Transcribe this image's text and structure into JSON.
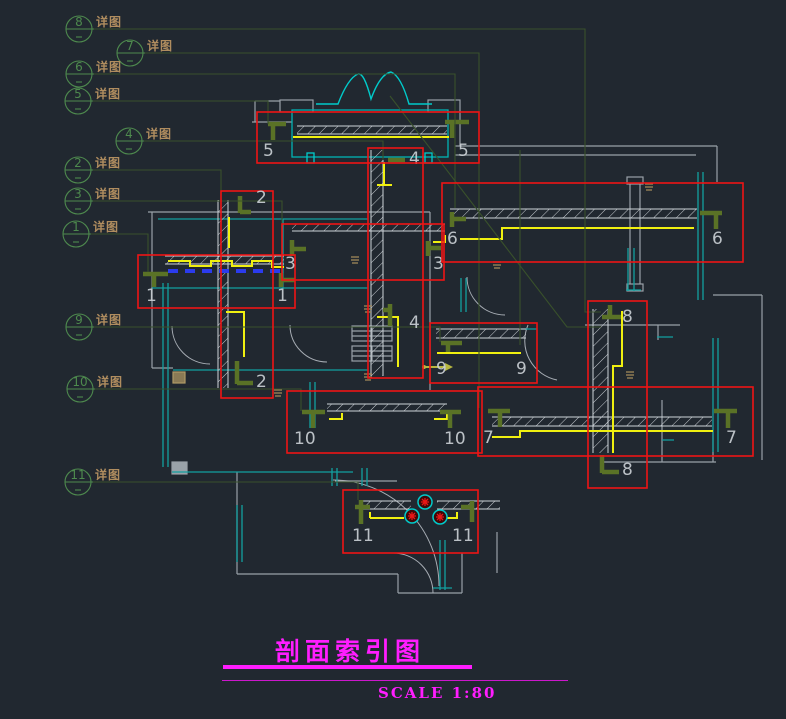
{
  "drawing": {
    "kind": "cad-section-index-plan",
    "title_block": {
      "title": "剖面索引图",
      "scale": "SCALE 1:80"
    },
    "detail_label": "详图",
    "colors": {
      "background": "#212830",
      "callout_red": "#ee1414",
      "yellow": "#f0f010",
      "wall_teal": "#12a0a0",
      "bright_cyan": "#00cbcb",
      "outline_gray": "#99a1a8",
      "hatch_light": "#cdd3d8",
      "section_olive": "#5a7226",
      "leader_green": "#39512b",
      "bubble_green": "#4e8a4e",
      "tan_text": "#b08d5f",
      "dash_blue": "#2b3bee",
      "label_gray": "#c9ced3",
      "title_magenta": "#ff1dff",
      "plant_red": "#e81616"
    },
    "bubbles": [
      {
        "num": "8",
        "cx": 79,
        "cy": 29,
        "leader": [
          [
            92,
            29
          ],
          [
            585,
            29
          ],
          [
            585,
            312
          ],
          [
            601,
            312
          ]
        ]
      },
      {
        "num": "7",
        "cx": 130,
        "cy": 53,
        "leader": [
          [
            143,
            53
          ],
          [
            479,
            53
          ],
          [
            479,
            408
          ]
        ]
      },
      {
        "num": "6",
        "cx": 79,
        "cy": 74,
        "leader": [
          [
            92,
            74
          ],
          [
            455,
            74
          ],
          [
            455,
            208
          ]
        ]
      },
      {
        "num": "5",
        "cx": 78,
        "cy": 101,
        "leader": [
          [
            91,
            101
          ],
          [
            268,
            101
          ],
          [
            268,
            124
          ]
        ]
      },
      {
        "num": "4",
        "cx": 129,
        "cy": 141,
        "leader": [
          [
            142,
            141
          ],
          [
            383,
            141
          ],
          [
            383,
            160
          ]
        ]
      },
      {
        "num": "2",
        "cx": 78,
        "cy": 170,
        "leader": [
          [
            91,
            170
          ],
          [
            221,
            170
          ],
          [
            221,
            194
          ]
        ]
      },
      {
        "num": "3",
        "cx": 78,
        "cy": 201,
        "leader": [
          [
            91,
            201
          ],
          [
            282,
            201
          ],
          [
            282,
            226
          ]
        ]
      },
      {
        "num": "1",
        "cx": 76,
        "cy": 234,
        "leader": [
          [
            89,
            234
          ],
          [
            148,
            234
          ],
          [
            148,
            272
          ]
        ]
      },
      {
        "num": "9",
        "cx": 79,
        "cy": 327,
        "leader": [
          [
            92,
            327
          ],
          [
            440,
            327
          ],
          [
            440,
            342
          ]
        ]
      },
      {
        "num": "10",
        "cx": 80,
        "cy": 389,
        "leader": [
          [
            93,
            389
          ],
          [
            301,
            389
          ],
          [
            301,
            411
          ]
        ]
      },
      {
        "num": "11",
        "cx": 78,
        "cy": 482,
        "leader": [
          [
            91,
            482
          ],
          [
            358,
            482
          ],
          [
            358,
            500
          ]
        ]
      }
    ],
    "extra_leaders": [
      [
        [
          390,
          96
        ],
        [
          567,
          327
        ],
        [
          601,
          327
        ]
      ],
      [
        [
          520,
          150
        ],
        [
          520,
          345
        ]
      ]
    ],
    "callouts": [
      {
        "num": "1",
        "x": 138,
        "y": 255,
        "w": 157,
        "h": 53,
        "labels": [
          [
            146,
            301
          ],
          [
            277,
            301
          ]
        ]
      },
      {
        "num": "2",
        "x": 221,
        "y": 191,
        "w": 52,
        "h": 207,
        "labels": [
          [
            256,
            203
          ],
          [
            256,
            387
          ]
        ]
      },
      {
        "num": "3",
        "x": 282,
        "y": 224,
        "w": 162,
        "h": 56,
        "labels": [
          [
            285,
            269
          ],
          [
            433,
            269
          ]
        ]
      },
      {
        "num": "4",
        "x": 368,
        "y": 148,
        "w": 55,
        "h": 230,
        "labels": [
          [
            409,
            164
          ],
          [
            409,
            328
          ]
        ]
      },
      {
        "num": "5",
        "x": 257,
        "y": 112,
        "w": 222,
        "h": 51,
        "labels": [
          [
            263,
            156
          ],
          [
            458,
            156
          ]
        ]
      },
      {
        "num": "6",
        "x": 442,
        "y": 183,
        "w": 301,
        "h": 79,
        "labels": [
          [
            447,
            244
          ],
          [
            712,
            244
          ]
        ]
      },
      {
        "num": "7",
        "x": 478,
        "y": 387,
        "w": 275,
        "h": 69,
        "labels": [
          [
            483,
            443
          ],
          [
            726,
            443
          ]
        ]
      },
      {
        "num": "8",
        "x": 588,
        "y": 301,
        "w": 59,
        "h": 187,
        "labels": [
          [
            622,
            322
          ],
          [
            622,
            475
          ]
        ]
      },
      {
        "num": "9",
        "x": 430,
        "y": 323,
        "w": 107,
        "h": 60,
        "labels": [
          [
            436,
            374
          ],
          [
            516,
            374
          ]
        ]
      },
      {
        "num": "10",
        "x": 287,
        "y": 391,
        "w": 195,
        "h": 62,
        "labels": [
          [
            294,
            444
          ],
          [
            444,
            444
          ]
        ]
      },
      {
        "num": "11",
        "x": 343,
        "y": 490,
        "w": 135,
        "h": 63,
        "labels": [
          [
            352,
            541
          ],
          [
            452,
            541
          ]
        ]
      }
    ]
  }
}
